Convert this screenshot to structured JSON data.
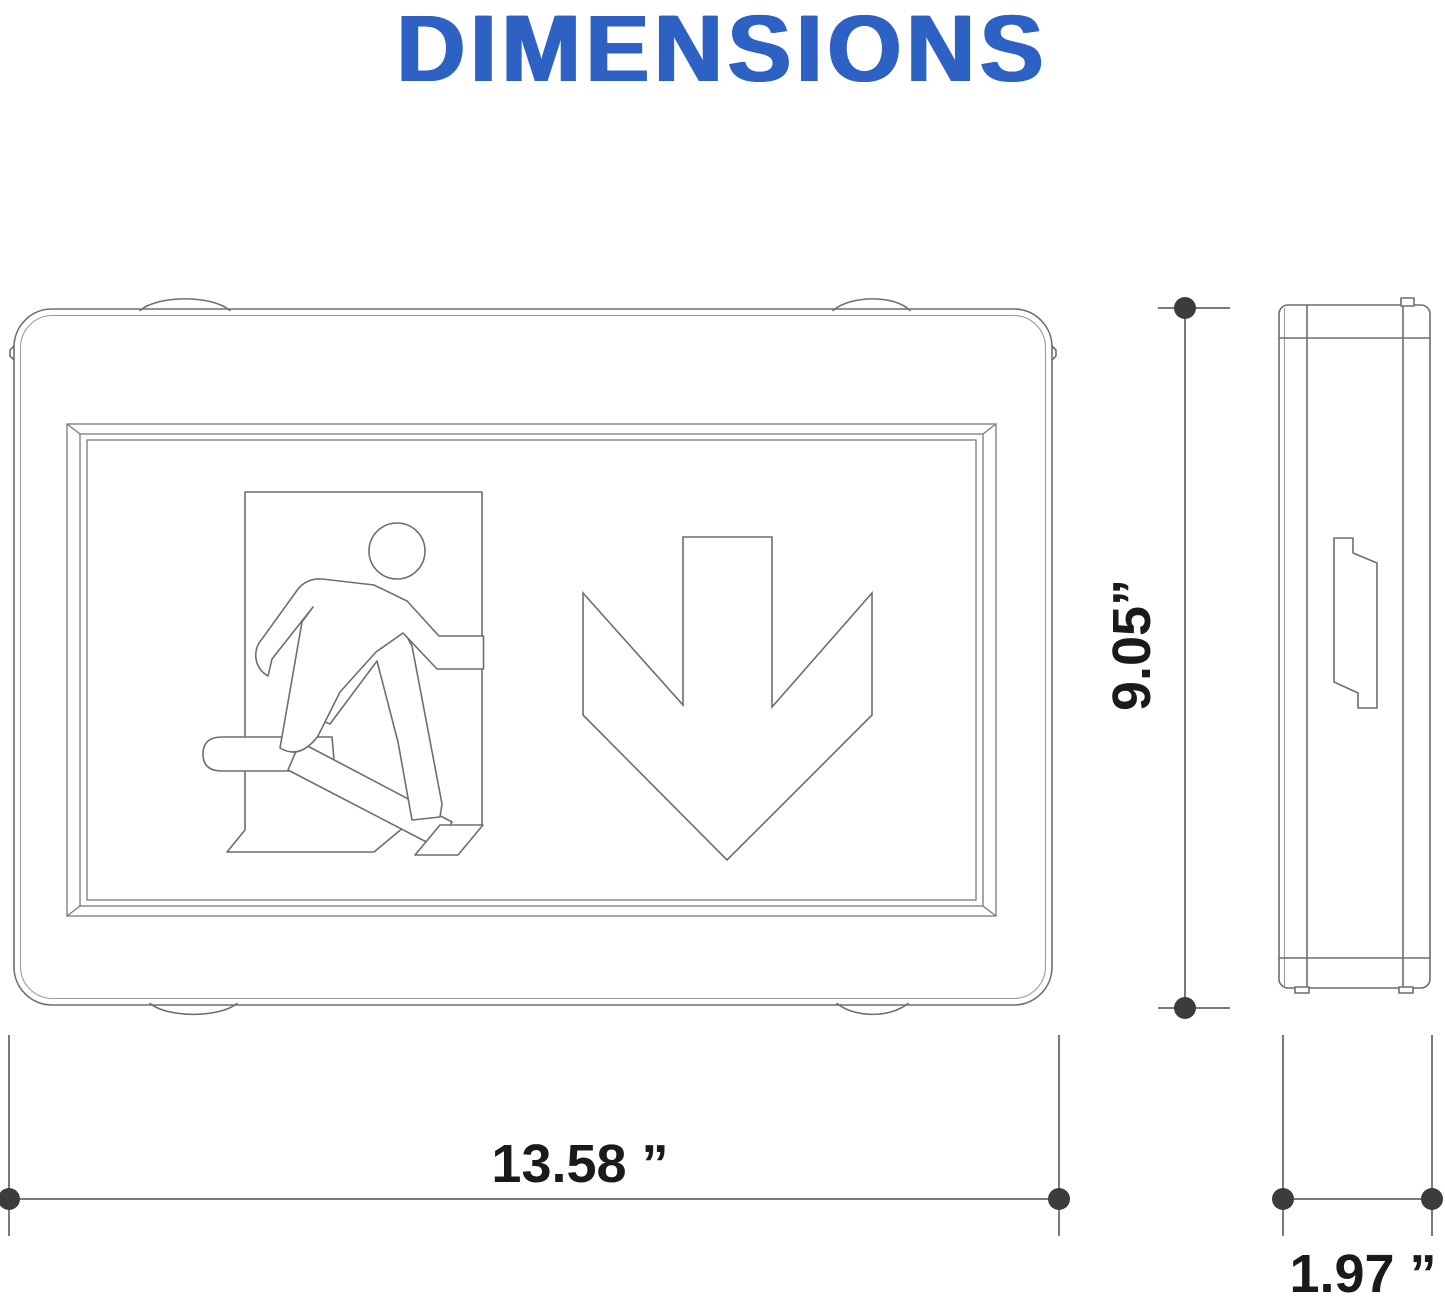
{
  "title": "DIMENSIONS",
  "dimension_labels": {
    "width": "13.58 ”",
    "height": "9.05”",
    "depth": "1.97 ”"
  },
  "icons": {
    "pictogram": "running-man-exit-icon",
    "arrow": "down-arrow-icon"
  },
  "colors": {
    "title_blue": "#2d62c4",
    "drawing_line_gray": "#6e6e6e",
    "dimension_line_gray": "#4f4f4f",
    "dimension_dot_gray": "#3c3c3c",
    "label_black": "#1a1a1a"
  }
}
